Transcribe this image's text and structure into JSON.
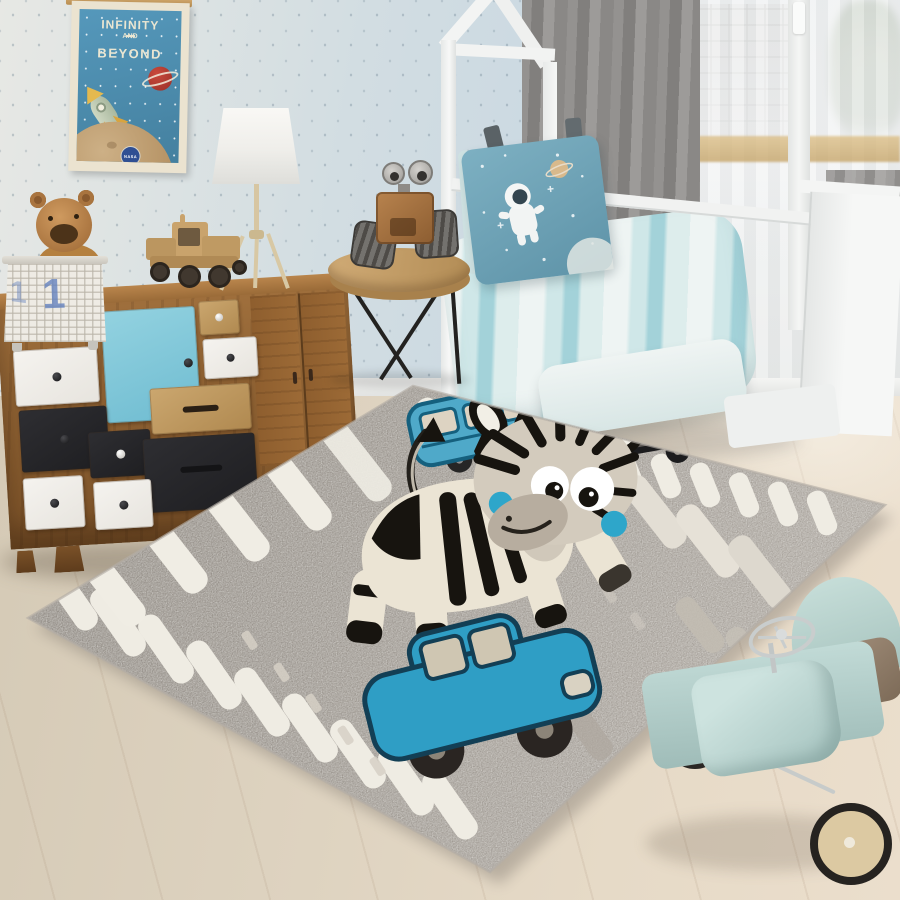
{
  "scene": {
    "description": "Children's bedroom photo: gray road-and-zebra play rug, wooden patchwork sideboard, white house-frame toddler bed with space pillow, toys",
    "objects": [
      "space-poster",
      "teddy-bear-in-basket",
      "patchwork-sideboard",
      "tripod-lamp",
      "wooden-toy-truck",
      "robot-toy",
      "round-side-table",
      "house-frame-bed",
      "astronaut-pillow",
      "gray-curtain",
      "sheer-window",
      "zebra-play-rug",
      "blue-bus-motif",
      "black-car-motif",
      "blue-car-motif",
      "mint-ride-on-car"
    ]
  },
  "poster": {
    "title_line1": "INFINITY",
    "title_line2": "AND",
    "title_line3": "BEYOND",
    "logo_text": "NASA"
  },
  "basket": {
    "number_front": "1",
    "number_side": "1"
  },
  "palette": {
    "wall_blue": "#c9d8e2",
    "floor_wood": "#e2d7c4",
    "rug_gray": "#97918a",
    "rug_stripe_white": "#efece3",
    "zebra_body": "#ebe4d4",
    "zebra_stripe": "#17140f",
    "zebra_cheek_blue": "#2ea6ca",
    "bus_blue": "#4fa9c9",
    "car_black": "#1c1c1e",
    "car_teal": "#2f9ec5",
    "bedding_teal": "#a3d2d9",
    "pillow_blue": "#6aa2b5",
    "curtain_gray": "#8a8886",
    "dresser_wood": "#8f6233",
    "dresser_door_blue": "#7cc4d8",
    "ride_on_mint": "#b7d3cf",
    "poster_blue": "#4f92b4"
  }
}
